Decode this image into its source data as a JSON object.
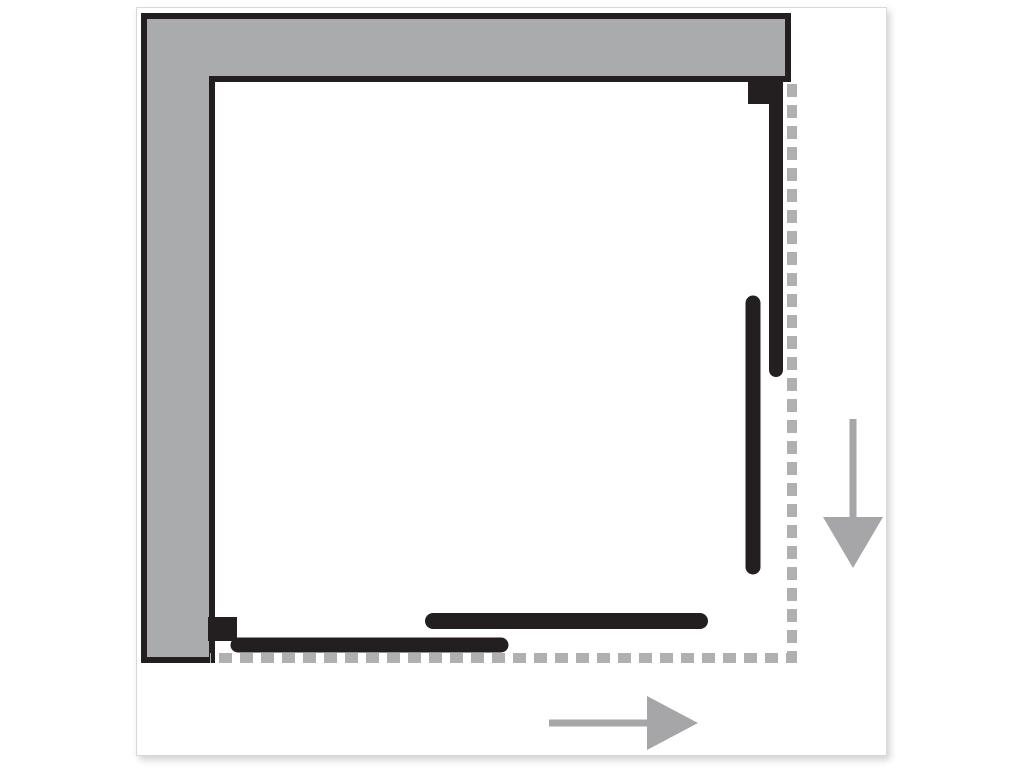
{
  "colors": {
    "page_bg": "#ffffff",
    "canvas_bg": "#ffffff",
    "canvas_border": "#d9d9d9",
    "wall_gray": "#a9abad",
    "black": "#231f20",
    "dash_gray": "#b0b0b0",
    "arrow_gray": "#a6a6a8"
  },
  "diagram": {
    "kind": "corner-shower-enclosure-plan-view",
    "wall": {
      "shape": "L",
      "sides": [
        "top",
        "left"
      ]
    },
    "panels": {
      "right_fixed_segment": "vertical fixed panel along right side",
      "right_sliding_door": "vertical sliding door along right side",
      "bottom_fixed_segment": "horizontal fixed panel along bottom side",
      "bottom_sliding_door": "horizontal sliding door along bottom side"
    },
    "footprint": {
      "style": "dashed",
      "sides": [
        "right",
        "bottom"
      ]
    },
    "icons": [
      {
        "name": "arrow-down-icon",
        "direction": "down"
      },
      {
        "name": "arrow-right-icon",
        "direction": "right"
      }
    ]
  }
}
